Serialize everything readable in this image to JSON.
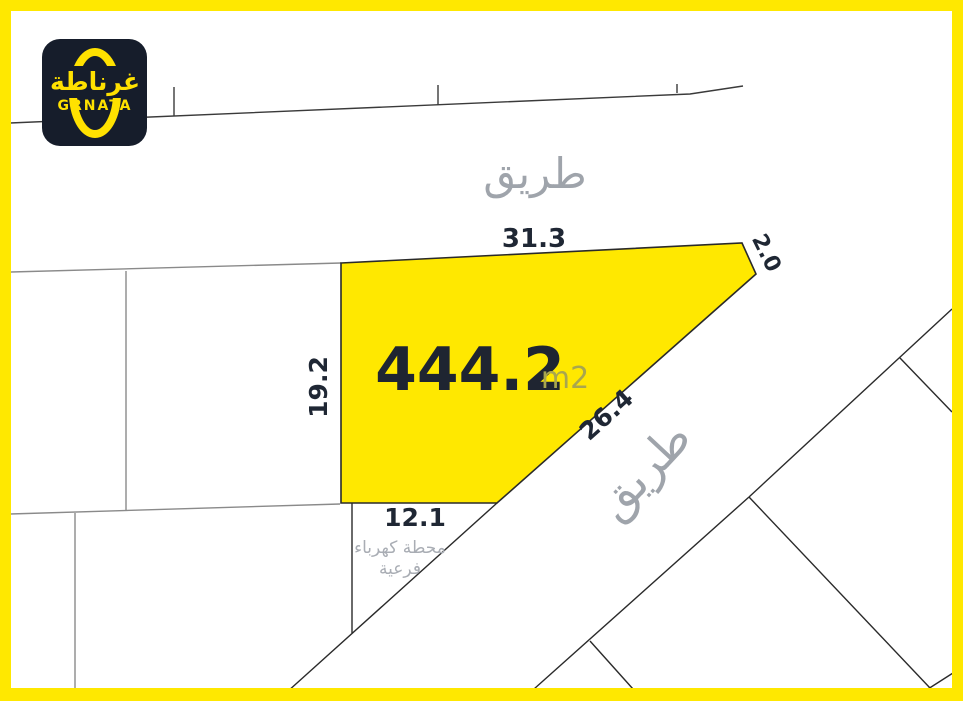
{
  "brand": {
    "name_en": "GRNATA",
    "name_ar": "غرناطة"
  },
  "map": {
    "area": {
      "value": "444.2",
      "unit": "m2"
    },
    "road_label_top": "طريق",
    "road_label_right": "طريق",
    "substation": {
      "line1": "محطة كهرباء",
      "line2": "فرعية"
    },
    "dimensions": {
      "top": "31.3",
      "corner_right": "2.0",
      "left": "19.2",
      "diagonal": "26.4",
      "bottom": "12.1"
    },
    "colors": {
      "frame_yellow": "#ffe800",
      "plot_fill": "#ffe800",
      "logo_bg": "#161d2b",
      "logo_yellow": "#ffe100",
      "navy_text": "#1f2734",
      "gray_text": "#9fa4ab",
      "unit_text": "#a8a64f"
    }
  }
}
